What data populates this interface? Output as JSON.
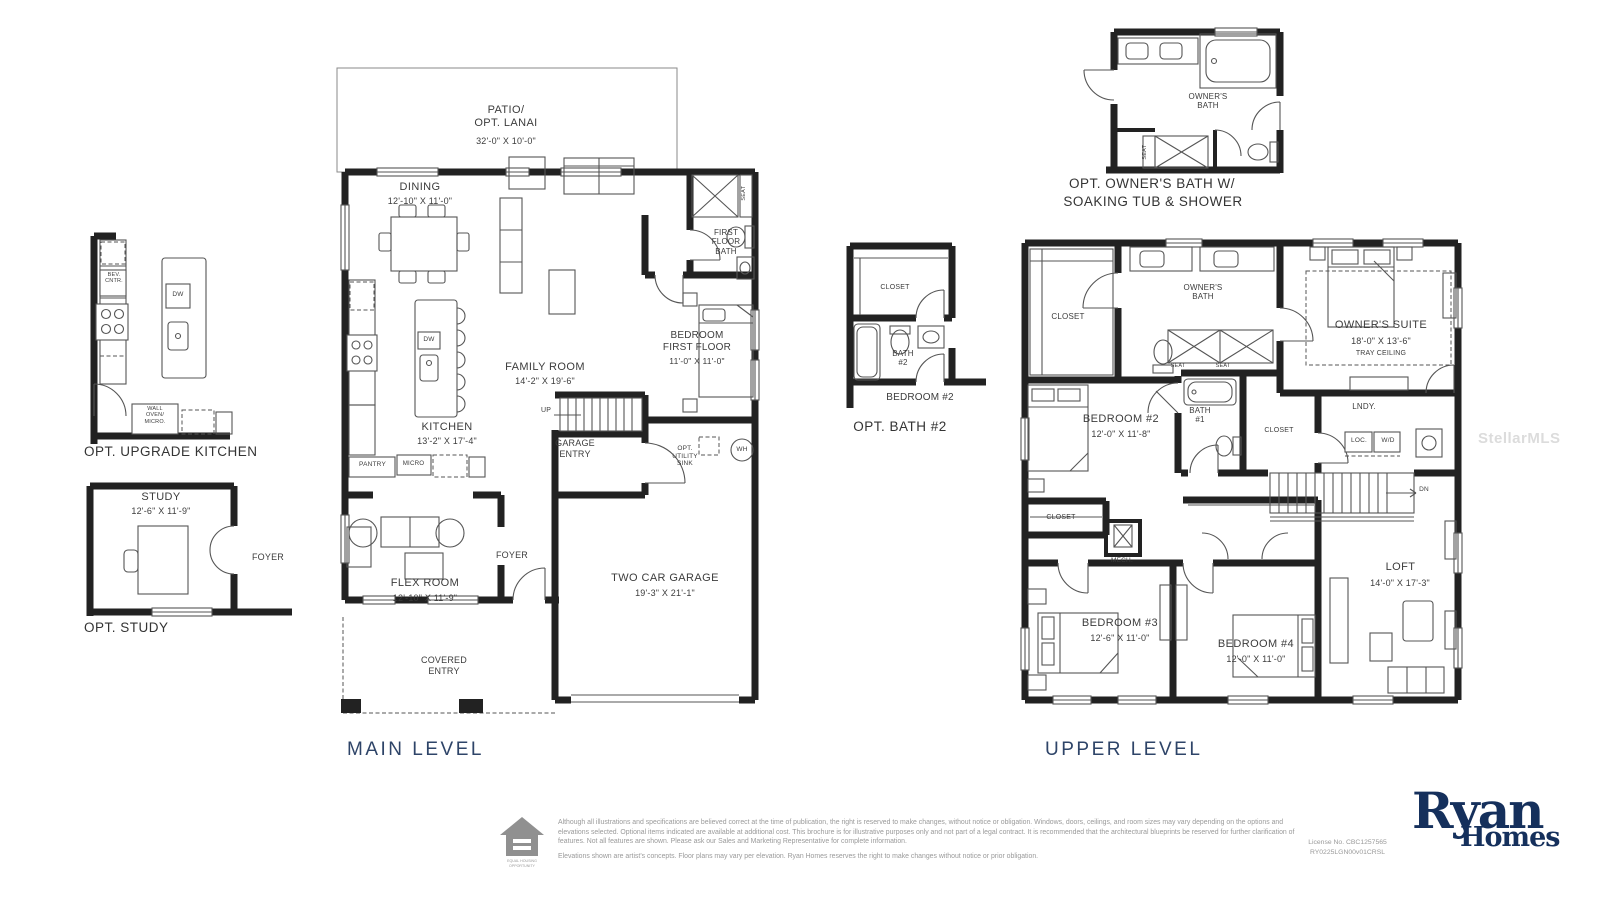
{
  "watermark": "StellarMLS",
  "kitchen_plan": {
    "caption": "OPT. UPGRADE KITCHEN",
    "bev_cntr": "BEV.\nCNTR.",
    "dw": "DW",
    "wall_oven": "WALL\nOVEN/\nMICRO."
  },
  "study_plan": {
    "caption": "OPT. STUDY",
    "room": "STUDY",
    "dims": "12'-6\" X 11'-9\"",
    "foyer": "FOYER"
  },
  "owners_bath_plan": {
    "caption_line1": "OPT. OWNER'S BATH W/",
    "caption_line2": "SOAKING TUB & SHOWER",
    "room": "OWNER'S\nBATH",
    "seat": "SEAT"
  },
  "bath2_plan": {
    "caption": "OPT. BATH #2",
    "closet": "CLOSET",
    "bath": "BATH\n#2",
    "bedroom": "BEDROOM #2"
  },
  "main_level": {
    "caption": "MAIN LEVEL",
    "patio": "PATIO/\nOPT. LANAI",
    "patio_dims": "32'-0\" X 10'-0\"",
    "dining": "DINING",
    "dining_dims": "12'-10\" X 11'-0\"",
    "family_room": "FAMILY ROOM",
    "family_room_dims": "14'-2\" X 19'-6\"",
    "kitchen": "KITCHEN",
    "kitchen_dims": "13'-2\" X 17'-4\"",
    "bedroom_ff": "BEDROOM\nFIRST FLOOR",
    "bedroom_ff_dims": "11'-0\" X 11'-0\"",
    "first_floor_bath": "FIRST\nFLOOR\nBATH",
    "seat": "SEAT",
    "garage_entry": "GARAGE\nENTRY",
    "up": "UP",
    "opt_utility_sink": "OPT.\nUTILITY\nSINK",
    "wh": "WH",
    "pantry": "PANTRY",
    "micro": "MICRO",
    "dw": "DW",
    "flex_room": "FLEX ROOM",
    "flex_room_dims": "12'-10\" X 11'-9\"",
    "foyer": "FOYER",
    "garage": "TWO CAR GARAGE",
    "garage_dims": "19'-3\" X 21'-1\"",
    "covered_entry": "COVERED\nENTRY"
  },
  "upper_level": {
    "caption": "UPPER LEVEL",
    "owners_suite": "OWNER'S SUITE",
    "owners_suite_dims": "18'-0\" X 13'-6\"",
    "tray_ceiling": "TRAY CEILING",
    "owners_bath": "OWNER'S\nBATH",
    "closet_walkin": "CLOSET",
    "closet_owners": "CLOSET",
    "closet_b2": "CLOSET",
    "seat1": "SEAT",
    "seat2": "SEAT",
    "bedroom2": "BEDROOM #2",
    "bedroom2_dims": "12'-0\" X 11'-8\"",
    "bath1": "BATH\n#1",
    "lndy": "LNDY.",
    "loc": "LOC.",
    "wd": "W/D",
    "dn": "DN",
    "mech": "MECH.",
    "bedroom3": "BEDROOM #3",
    "bedroom3_dims": "12'-6\" X 11'-0\"",
    "bedroom4": "BEDROOM #4",
    "bedroom4_dims": "12'-0\" X 11'-0\"",
    "loft": "LOFT",
    "loft_dims": "14'-0\" X 17'-3\""
  },
  "footer": {
    "disclaimer_1": "Although all illustrations and specifications are believed correct at the time of publication, the right is reserved to make changes, without notice or obligation. Windows, doors, ceilings, and room sizes may vary depending on the options and elevations selected. Optional items indicated are available at additional cost. This brochure is for illustrative purposes only and not part of a legal contract. It is recommended that the architectural blueprints be reserved for further clarification of features. Not all features are shown. Please ask our Sales and Marketing Representative for complete information.",
    "disclaimer_2": "Elevations shown are artist's concepts. Floor plans may vary per elevation. Ryan Homes reserves the right to make changes without notice or prior obligation.",
    "license_line1": "License No. CBC1257565",
    "license_line2": "RY0225LGN00v01CRSL",
    "equal_housing": "EQUAL HOUSING\nOPPORTUNITY",
    "brand_line1": "Ryan",
    "brand_line2": "Homes"
  }
}
